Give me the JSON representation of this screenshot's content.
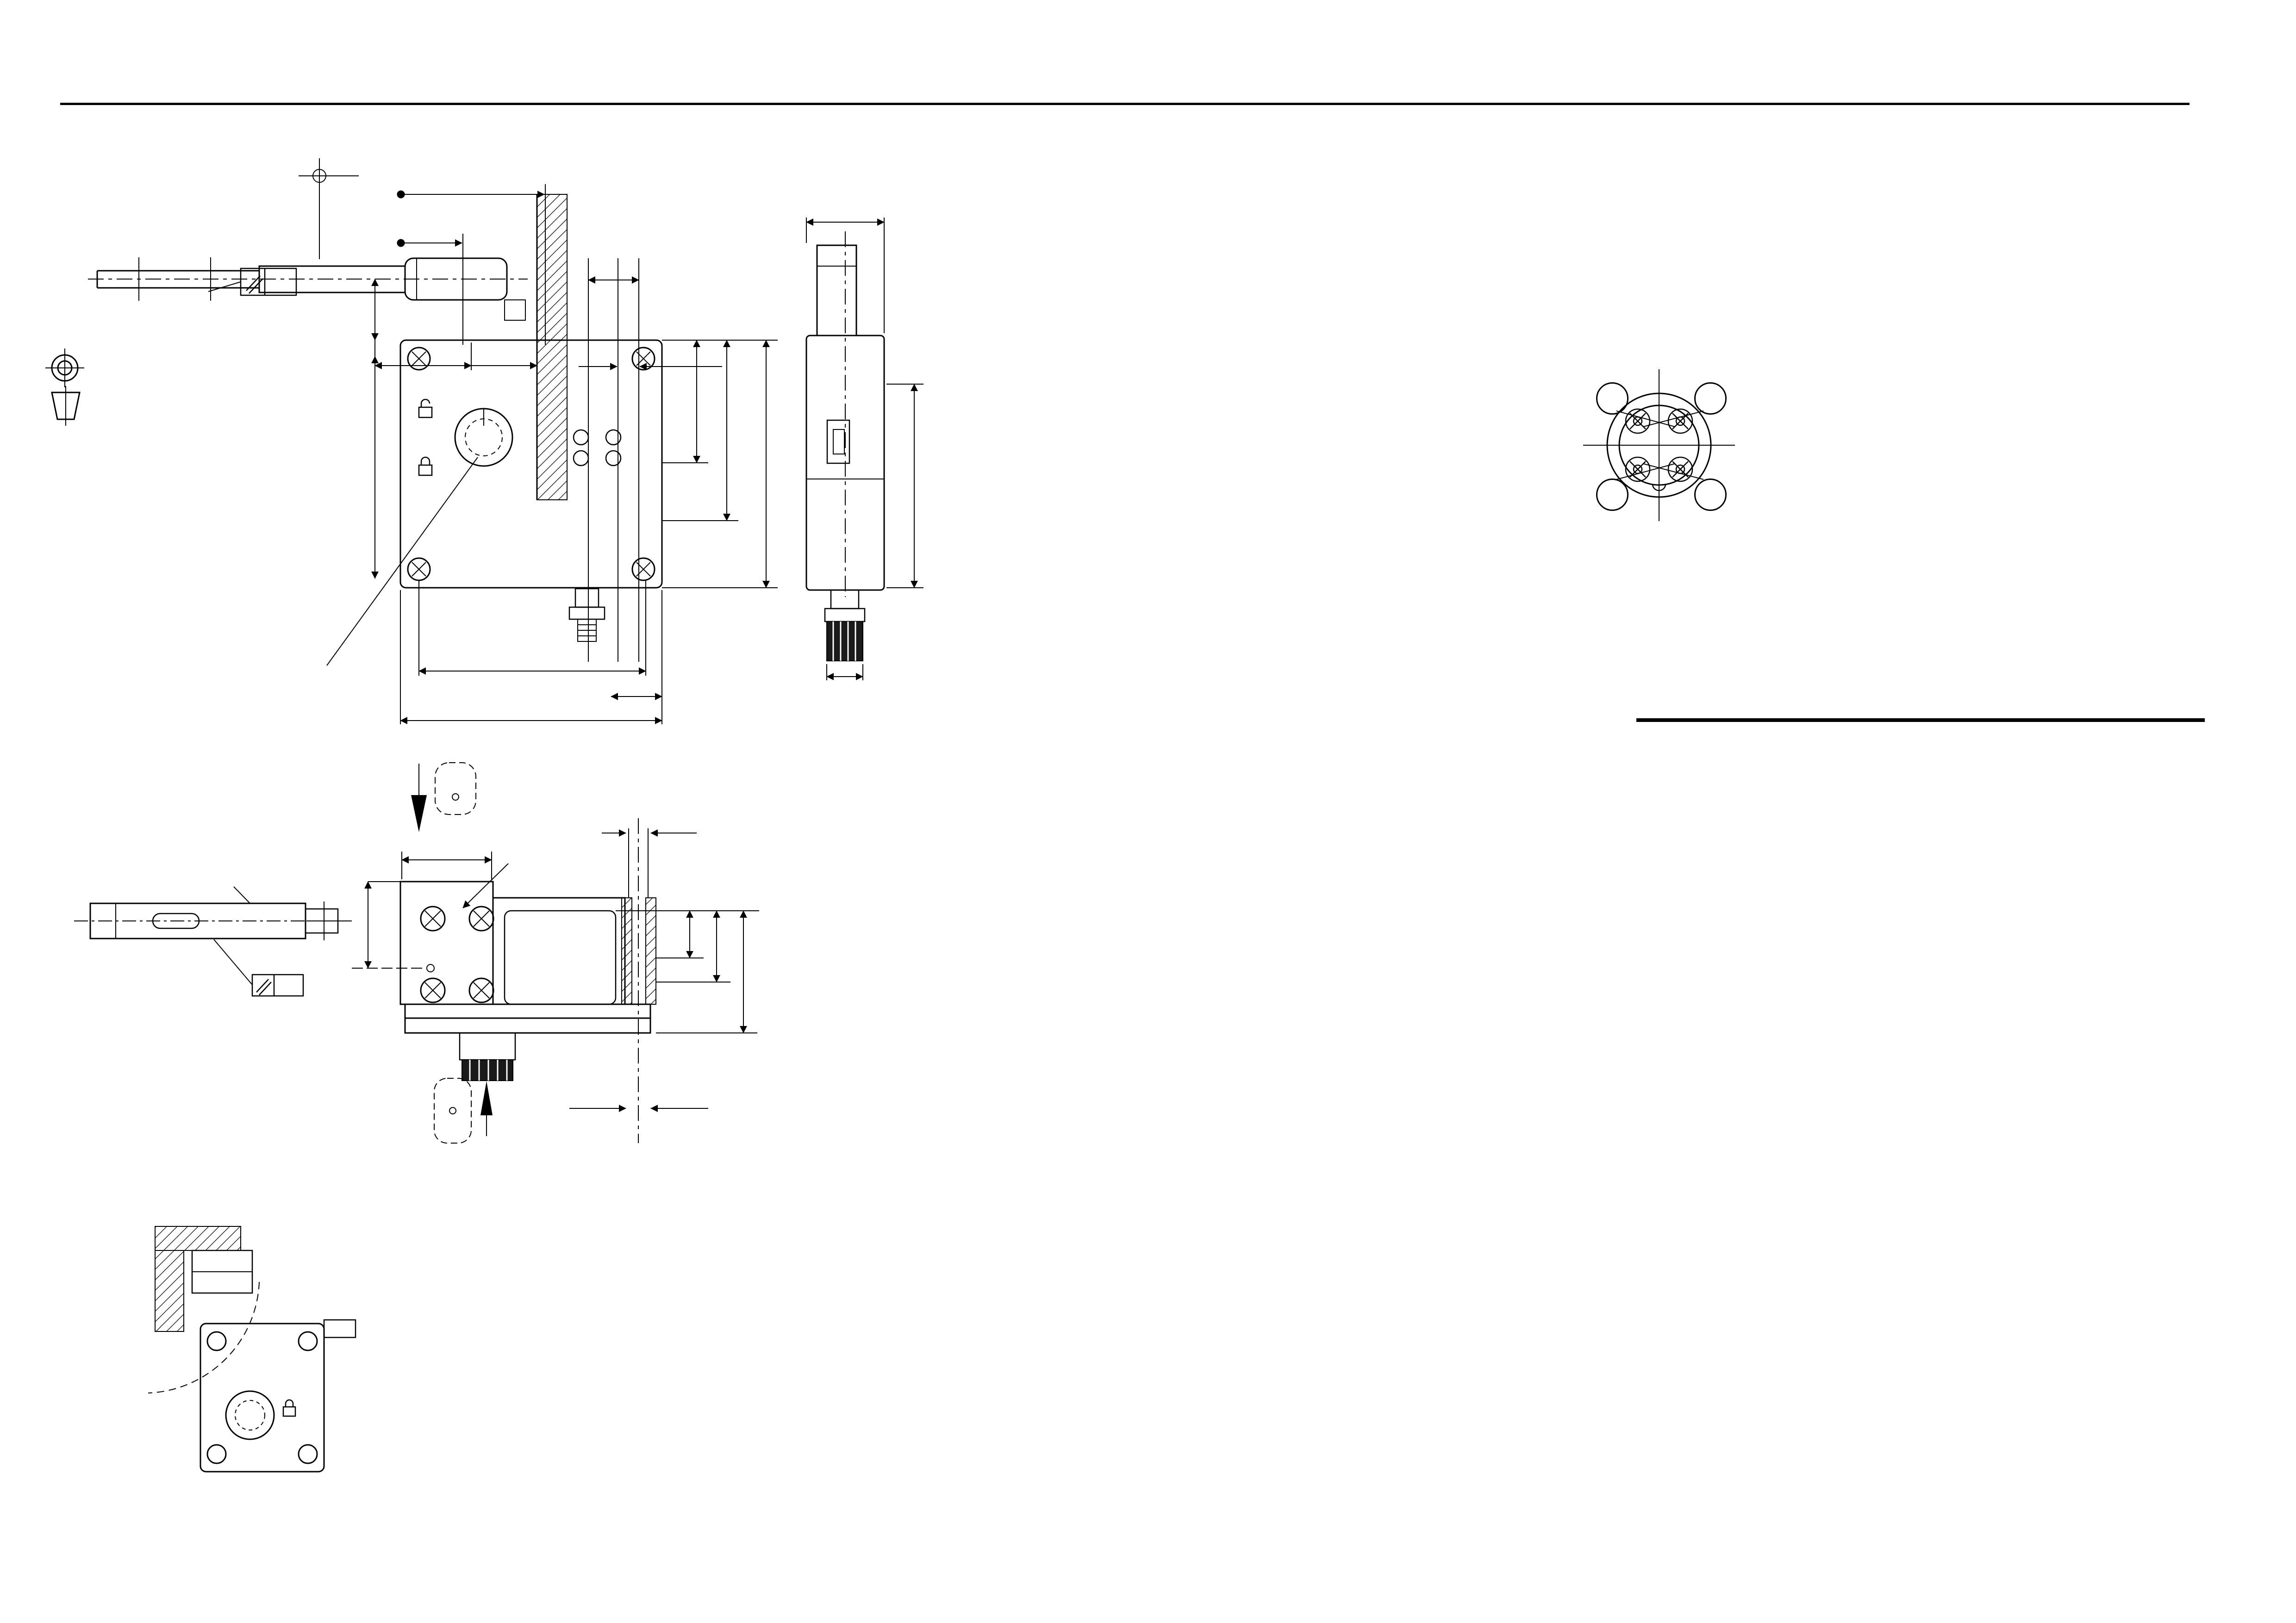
{
  "header": {
    "doc": "Datenblatt / Data Sheet",
    "part": "TZ..E...SEM4AS1-C1937",
    "brand": "EUCHNER"
  },
  "sidebar": {
    "dims": "Maße in mm / Dimension in mm",
    "copyright": "© EUCHNER GmbH + Co KG",
    "disclaimer": "Technische Änderungen vorbehalten, alle Angaben ohne Gewähr / Subject to technical modifications;      no responsibility is accepted for the accuracy of this information."
  },
  "illu": {
    "title": "Illustration:",
    "variant": "TZ.L... actuating head on left.\n(actuating head on right\n is mirror image)",
    "warn1": "When using the Emergency\nRelease make sure there\nis no tractive force\napplied on the actuator.",
    "steps": "Emergency release\nTake the seal off before\nactuating the emergency\nrelease.\nThen turn the rotary knob\nclockwise until it snaps in.\nBefore resetting push the\nsnap-in spike in as far as\nit will go with a pin  ∅3.",
    "warn2": "When releasing the emergency\nunlocking,no tensile forces\nmust act ont the actuator.",
    "lead": "The lead has to be restored\nafter readjusting the emergency\nunlocking.",
    "tzr": "TZ.R..",
    "er": "Emergency\nRelease"
  },
  "notes": {
    "a": "a  Pre-travel:\n    The actuator is in the\n    guide, but does not initiate\n    switching operation.",
    "b": "b  Switching operation complete:\n    The actuator must be inserted\n    up to this point to ensure\n    reliable switching. The actuator\n    must be withdrawn at least to\n    point a) for switching off.",
    "n1": "1) Please order actuator separately",
    "n2": "2) The actuator head can be turned\n    to the desired approach direction\n    after undoing the fixing screws.",
    "n3": "3) For mounting on the machine the\n    safety switch and the actuator\n    have to be assembled",
    "n3b": "It is not allowed to use safety switch\nas a mechanical stop",
    "tz": "TZ1: Unlocking by applying voltage\nTZ2: Locking by applying voltage"
  },
  "pin": {
    "title": "Pin assignment SEM4 (M12)",
    "view": "View connection side",
    "plug": "Plug connector\nnot aligned",
    "legend": [
      {
        "n": "1",
        "t": "= ASi+"
      },
      {
        "n": "2",
        "t": "= Auxiliary power 0V"
      },
      {
        "n": "3",
        "t": "= ASi-"
      },
      {
        "n": "4",
        "t": "= Auxiliary power +24V"
      }
    ],
    "pins": {
      "tl": "4",
      "tr": "3",
      "bl": "1",
      "br": "2"
    }
  },
  "id_table": {
    "headers": [
      "ID No.",
      "Type",
      "Solenoid voltages"
    ],
    "rows": [
      [
        "090279",
        "TZ1RE024SEM4AS1-C1937",
        "24V"
      ],
      [
        "090278",
        "TZ1LE024SEM4AS1-C1937",
        "24V"
      ]
    ]
  },
  "params": {
    "headers": {
      "l": "Parameter",
      "v": "Value",
      "u": "Unit"
    },
    "groups": [
      {
        "rows": [
          {
            "l": "Housing material",
            "v": "Anodized die-cast alloy",
            "u": ""
          },
          {
            "l": "Environmental protection to IEC 60529",
            "v": "IP65",
            "u": ""
          },
          {
            "l": "Mechanical operations",
            "v": "1 x 10⁶",
            "u": ""
          },
          {
            "l": "Ambient temperature",
            "v": "-25 to +55",
            "u": "°C"
          },
          {
            "l": "Mounting position",
            "v": "optional",
            "u": ""
          },
          {
            "l": "Approach speed max.",
            "v": "20",
            "u": "m/min"
          },
          {
            "l": "Operating-, Extraction-, Retainig force (20°C)",
            "v": "35 / 30 / 10",
            "u": "N"
          },
          {
            "l": "Weight",
            "v": "1,07",
            "u": "Kg"
          }
        ]
      },
      {
        "title": {
          "l": "SWITCH ELEMENT",
          "v": "",
          "u": ""
        },
        "rows": [
          {
            "l": "Switching principle",
            "v": "Positively driven, slow-action switching element",
            "u": ""
          },
          {
            "l": "EMC protection requirements",
            "v": "acc. to EN 50295 (ASI-Interface standard) and IEC 62026",
            "u": ""
          },
          {
            "l": "Plug connector (No.of contacts)",
            "v": "M12 (4-pin)",
            "u": ""
          }
        ]
      },
      {
        "title": {
          "l": "Interlocking solenoid:",
          "v": "",
          "u": ""
        },
        "rows": [
          {
            "l": "Solenoid operating voltage",
            "v": "24 +10%/-15% (IEC 60742, PELV)",
            "u": "VDC"
          },
          {
            "l": "(auxiliary power on black AS-Interface line)",
            "v": "Power supply unit with safe isolation",
            "u": ""
          },
          {
            "l": "Duty cycle",
            "v": "100",
            "u": "%"
          },
          {
            "l": "Solenoid operating current",
            "v": "350",
            "u": "mA"
          }
        ]
      },
      {
        "title": {
          "l": "AS-Interface data",
          "v": "EA-Code: 7    ID-Code: B",
          "u": ""
        },
        "rows": [
          {
            "l": "Total current sonsumption, max.",
            "v": "45",
            "u": "mA"
          },
          {
            "l": "AS-Interface input SK (Door monitoring contact)",
            "v": "D0, D1 acc. with AS-Interface  \"Safety at Work\"",
            "u": ""
          },
          {
            "l": "AS-Interface input ÜK (Solenoid monitoring contact )",
            "v": "D2, D3 acc. with AS-Interface  \"Safety at Work\"",
            "u": ""
          },
          {
            "l": "AS-Interface outputs:",
            "v": "",
            "u": ""
          },
          {
            "l": "D0",
            "v": "Interlocking solenoid, 1=solenoid energized",
            "u": "",
            "ind": true
          },
          {
            "l": "D1",
            "v": "LED reed, 1=LED on",
            "u": "",
            "ind": true
          },
          {
            "l": "D2",
            "v": "LED green 1=LED on",
            "u": "",
            "ind": true
          },
          {
            "l": "AS-Interface LED \"POWER\"",
            "v": "Green, AS.Interface Power on",
            "u": ""
          },
          {
            "l": "AS-Interface LED \"FAULT\"",
            "v": "RED, offline phase or address 0",
            "u": ""
          }
        ]
      }
    ]
  },
  "drw": {
    "plus4": "+4",
    "d52": "52",
    "z0": "0",
    "b": "b",
    "d23": "23",
    "a": "a",
    "d25": "25",
    "d36": "36",
    "d22": "22",
    "d125": "12,5",
    "d36v": "36",
    "d100v": "100",
    "d415": "41,5",
    "d605": "60,5",
    "d110v": "110",
    "m4x": "M=1,2Nm(4x)",
    "d100b": "100",
    "d35": "35",
    "d110b": "110",
    "d31": "31",
    "d40s": "40",
    "d20s": "20",
    "gn": "GN",
    "rd": "RD",
    "pw": "Power",
    "fl": "Fault",
    "n2a": "2)",
    "dD": "D",
    "d40m": "40",
    "m4x2": "M=1,2Nm(4x)",
    "d20m": "20",
    "m8": "M8",
    "d15": "15",
    "d37": "37",
    "d46": "46",
    "bUp": "B",
    "n2b": "2)",
    "bR": "B",
    "d55": "∅5,5",
    "n1": "1)",
    "ec": "E(C)",
    "n3a": "3)",
    "flat": "0,3",
    "n3b": "3)",
    "flat2": "0,3"
  },
  "footer": {
    "l1": "103540 - 3 - 10.02.2015 - LI - EL - VR - Blatt/sheet  1",
    "l2": "EUCHNER GMBH + Co. KG   Kohlhammerstraße 16    70771 Leinfelden-Echterdingen      Tel. +49/711/7597-0   Fax +49/711/753316    www.euchner.de   info@euchner.de"
  }
}
